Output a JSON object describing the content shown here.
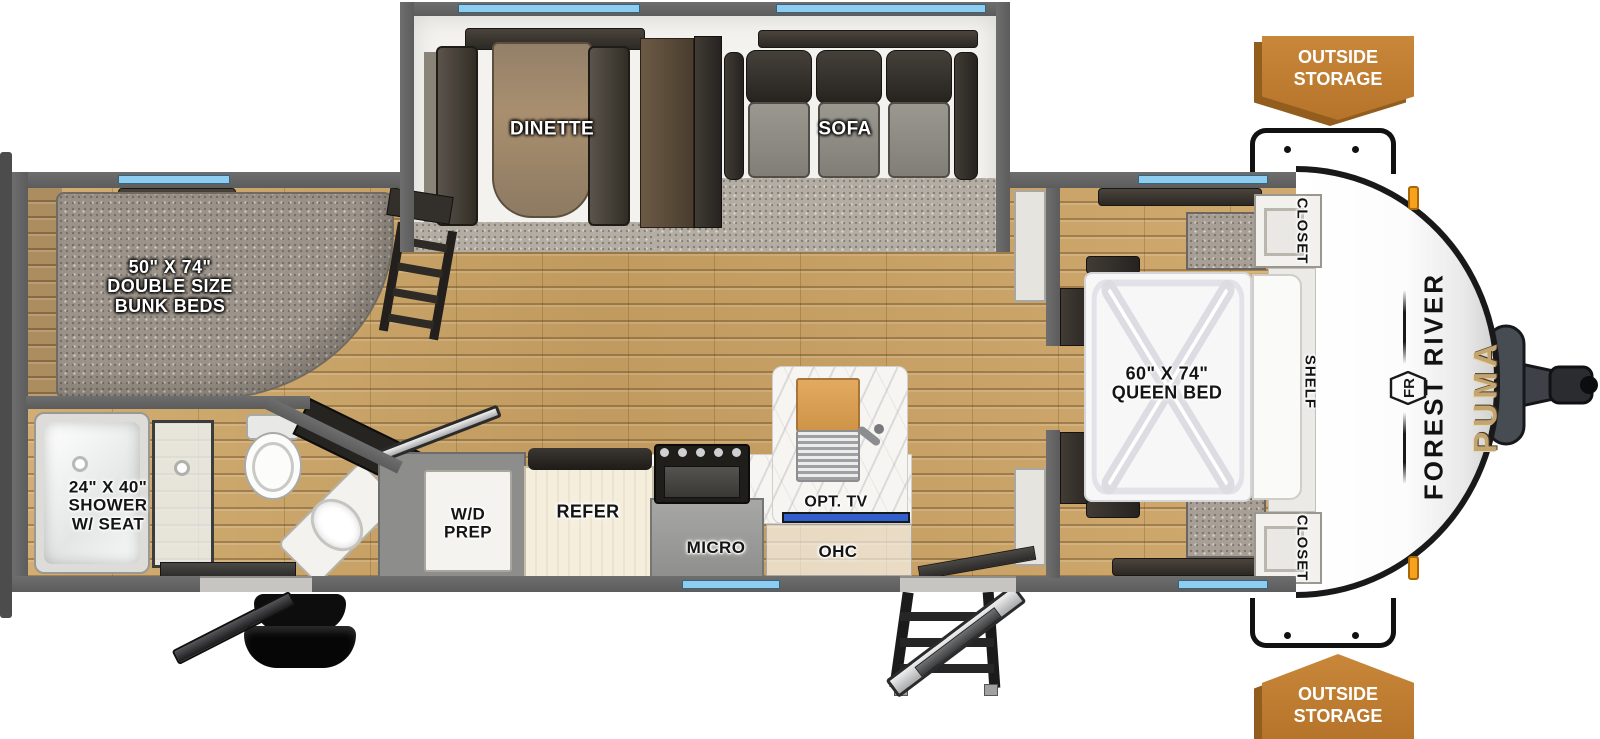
{
  "brand": {
    "manufacturer": "FOREST RIVER",
    "model": "PUMA",
    "logo_monogram": "FR"
  },
  "exterior": {
    "outside_storage_top": {
      "lines": [
        "OUTSIDE",
        "STORAGE"
      ]
    },
    "outside_storage_bottom": {
      "lines": [
        "OUTSIDE",
        "STORAGE"
      ]
    }
  },
  "bunk_room": {
    "label_lines": [
      "50\" X 74\"",
      "DOUBLE SIZE",
      "BUNK BEDS"
    ]
  },
  "bathroom": {
    "shower_label_lines": [
      "24\" X 40\"",
      "SHOWER",
      "W/ SEAT"
    ]
  },
  "bedroom": {
    "bed_label_lines": [
      "60\" X 74\"",
      "QUEEN BED"
    ],
    "closet_top": "CLOSET",
    "shelf": "SHELF",
    "closet_bottom": "CLOSET"
  },
  "living": {
    "dinette": "DINETTE",
    "sofa": "SOFA"
  },
  "kitchen": {
    "wd_prep_lines": [
      "W/D",
      "PREP"
    ],
    "refrigerator": "REFER",
    "microwave": "MICRO",
    "optional_tv": "OPT. TV",
    "overhead_cabinet": "OHC"
  },
  "colors": {
    "wall_gray": "#636363",
    "window_blue": "#8ecdef",
    "carpet_gray": "#a39b91",
    "wood_floor": "#c8a369",
    "badge_orange": "#bf7d2f",
    "badge_shadow": "#935d1e",
    "tv_blue": "#3160cc",
    "puma_gold": "#c3a571",
    "front_cap_white": "#fdfdfd",
    "trim_black": "#191919"
  }
}
